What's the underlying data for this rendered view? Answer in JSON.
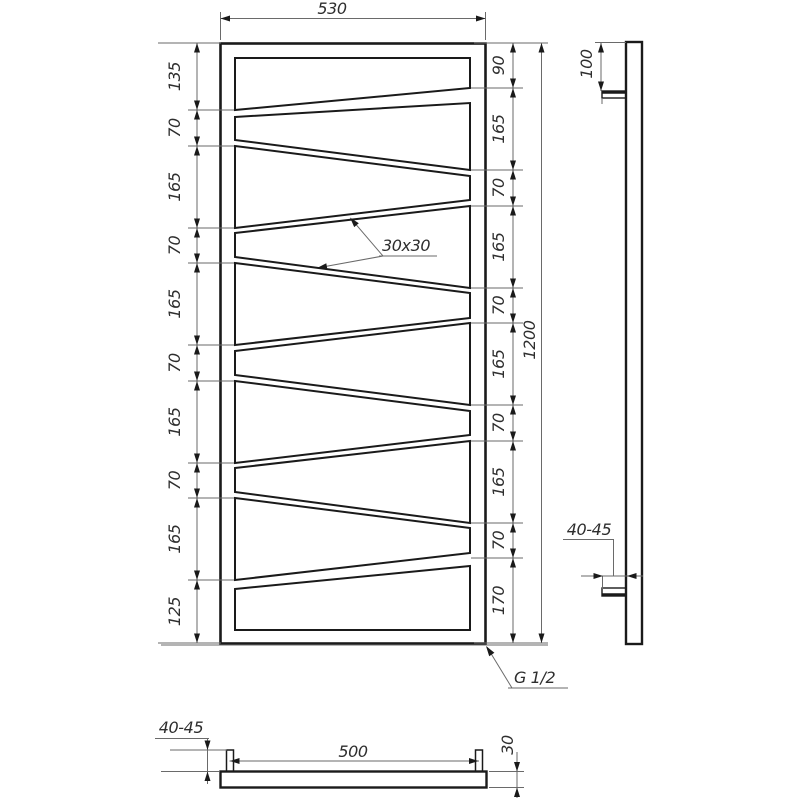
{
  "front_view": {
    "width": "530",
    "height": "1200",
    "left_chain": [
      "135",
      "70",
      "165",
      "70",
      "165",
      "70",
      "165",
      "70",
      "165",
      "125"
    ],
    "right_chain": [
      "90",
      "165",
      "70",
      "165",
      "70",
      "165",
      "70",
      "165",
      "70",
      "170"
    ],
    "tube_size": "30x30",
    "connection_thread": "G 1/2"
  },
  "side_view": {
    "top_bracket_offset": "100",
    "wall_clearance": "40-45"
  },
  "top_view": {
    "bracket_projection": "40-45",
    "bracket_spacing": "500",
    "depth": "30"
  },
  "colors": {
    "object_line": "#1a1a1a",
    "thin_line": "#6a6a6a",
    "text": "#2e2e2e",
    "background": "#ffffff"
  }
}
